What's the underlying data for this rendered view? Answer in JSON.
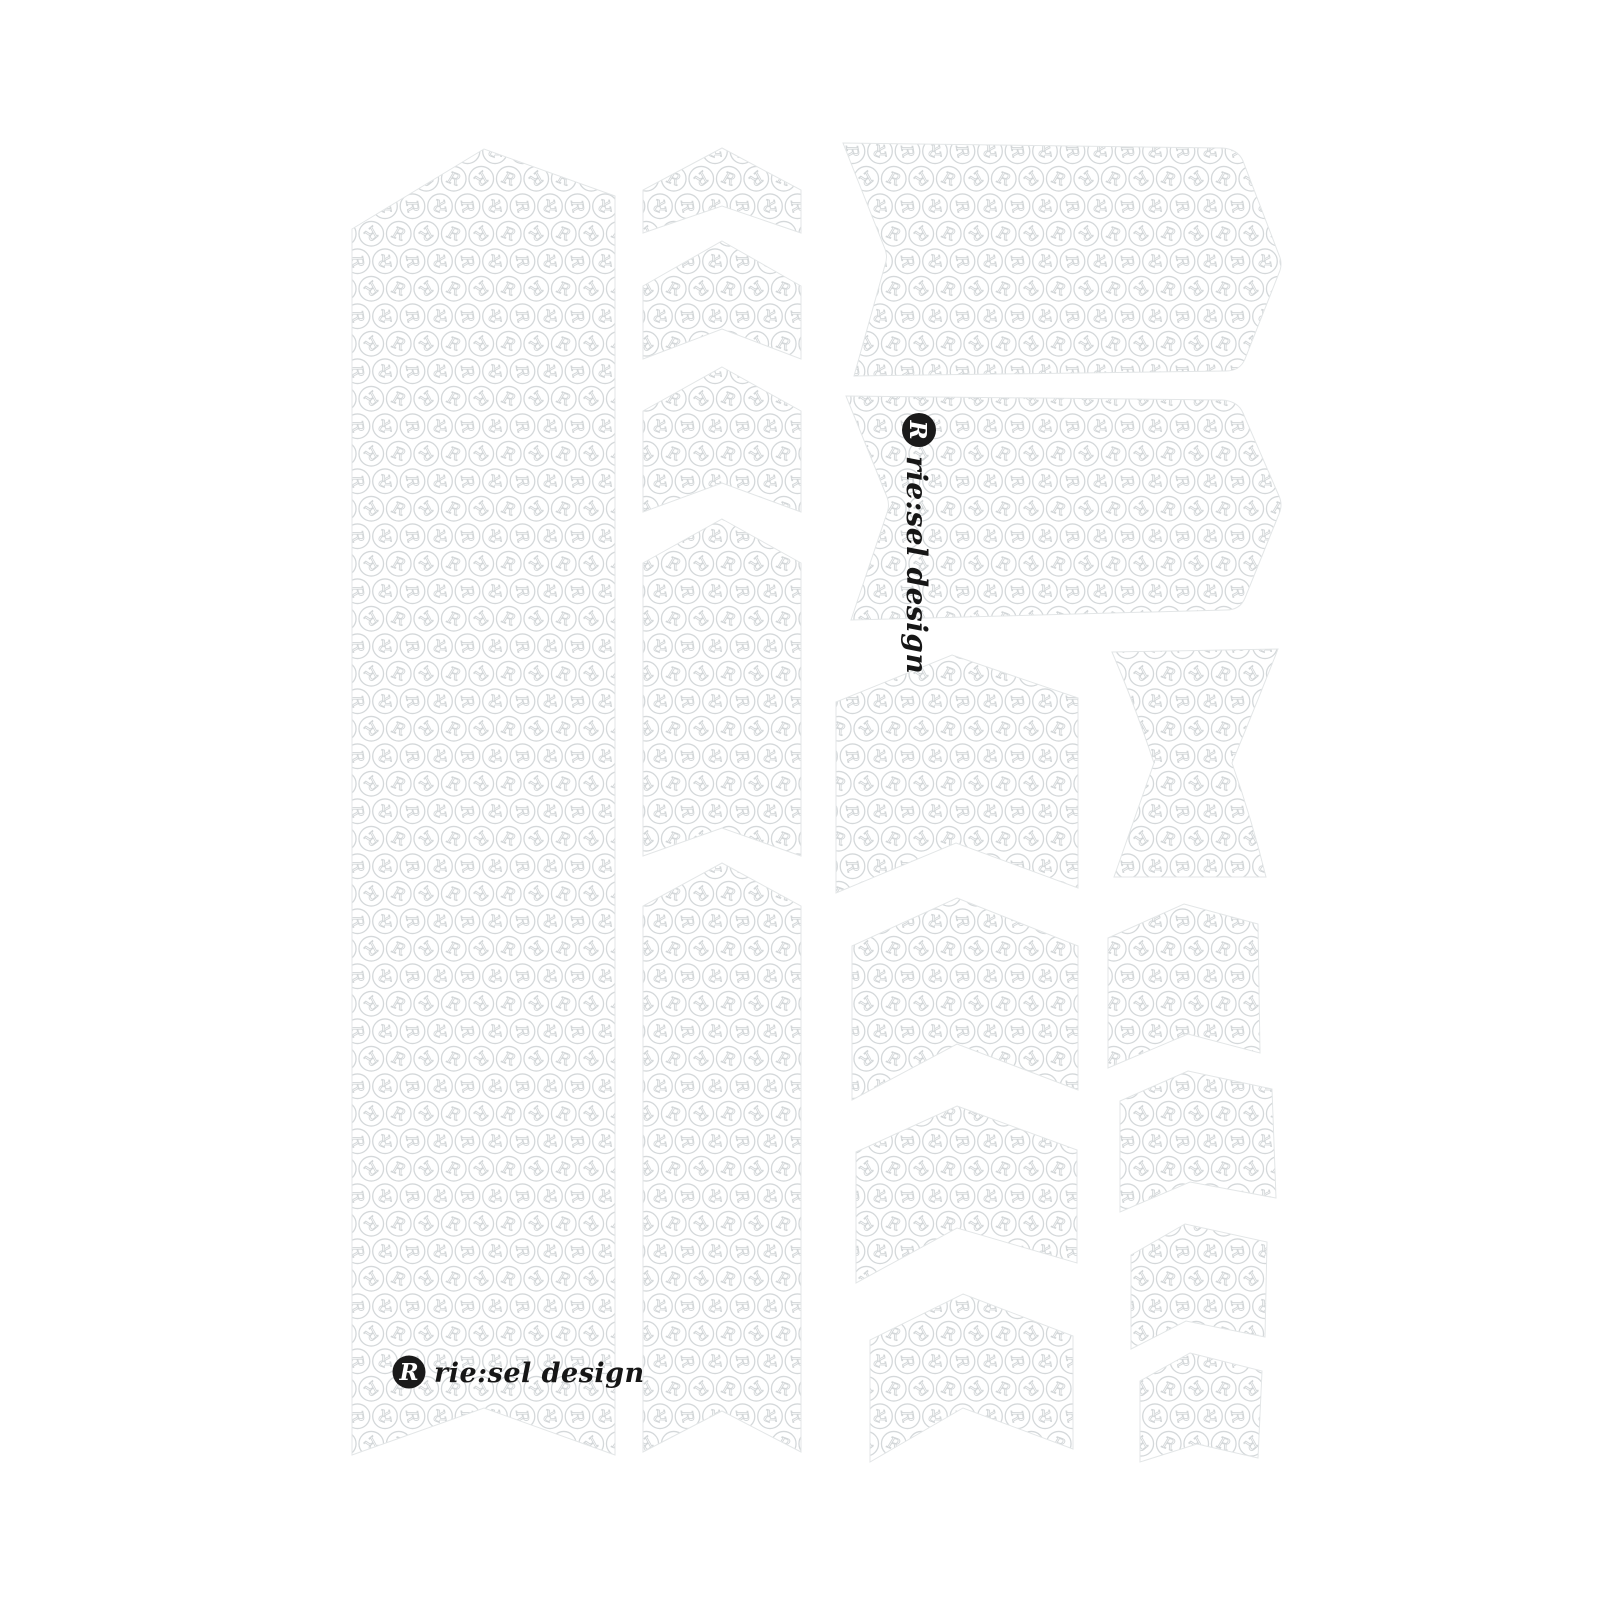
{
  "brand": {
    "name": "rie:sel design",
    "initial": "R",
    "icon": "riesel-logo-icon",
    "color": "#1a1a1a"
  },
  "pattern": {
    "glyph": "R",
    "icon": "riesel-monogram-texture",
    "stroke_color": "#d4d8da",
    "background_color": "#ffffff"
  },
  "sheet": {
    "background_color": "#ffffff",
    "piece_count": "17"
  }
}
